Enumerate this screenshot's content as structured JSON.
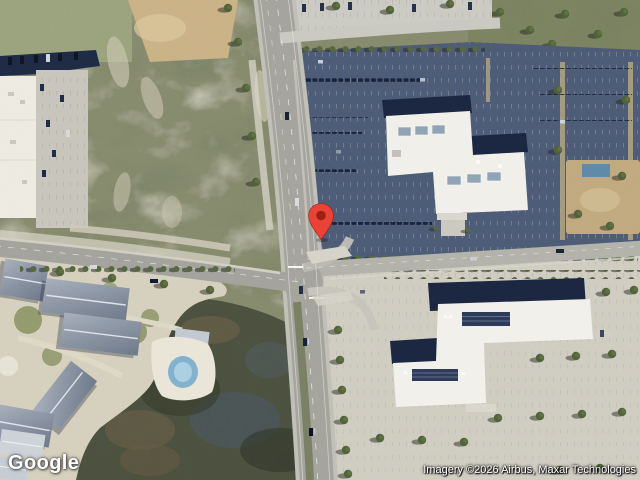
{
  "map": {
    "view_type": "satellite",
    "logo": {
      "text": "Google"
    },
    "attribution": {
      "text": "Imagery ©2026 Airbus, Maxar Technologies"
    },
    "marker": {
      "color": "#EA4335",
      "dot_color": "#9A220F"
    }
  }
}
